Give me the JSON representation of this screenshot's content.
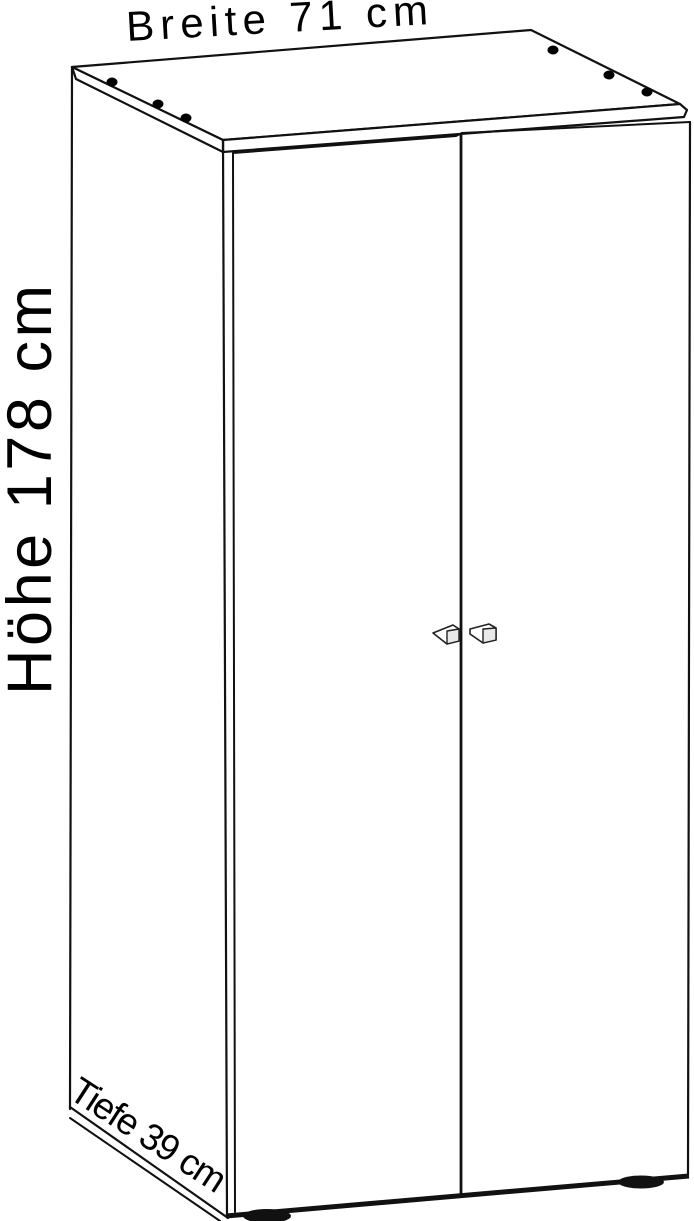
{
  "diagram": {
    "type": "furniture-dimension-drawing",
    "item": "two-door-wardrobe",
    "labels": {
      "width": "Breite 71 cm",
      "height": "Höhe 178 cm",
      "depth": "Tiefe 39 cm"
    },
    "dimensions_cm": {
      "width": 71,
      "height": 178,
      "depth": 39
    },
    "colors": {
      "line": "#111111",
      "text": "#000000",
      "background": "#ffffff",
      "handle_face": "#e9e9e9",
      "cam_hole": "#000000"
    }
  }
}
